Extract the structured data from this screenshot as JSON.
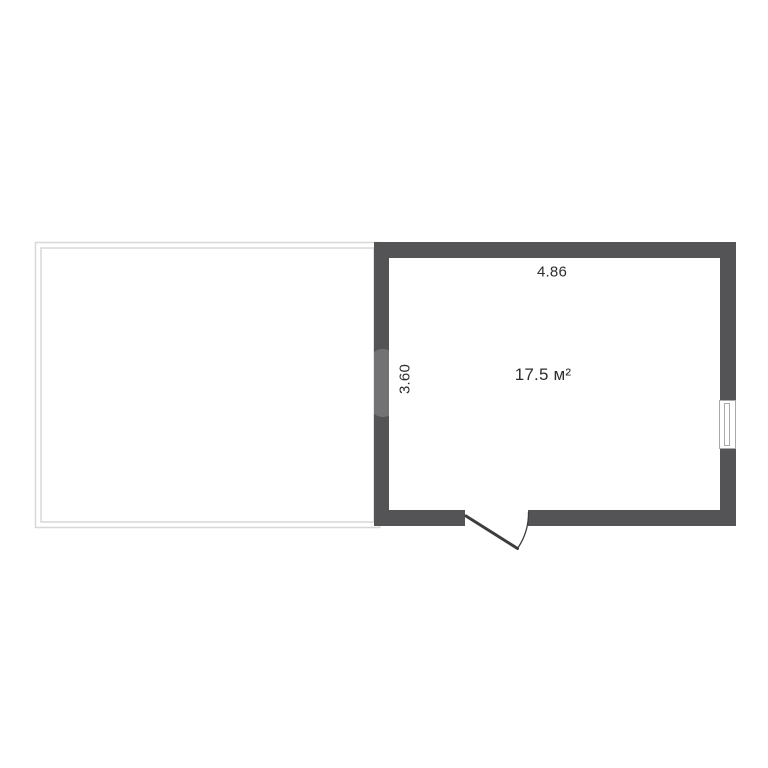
{
  "floor_plan": {
    "labels": {
      "room_width_m": "4.86",
      "room_height_m": "3.60",
      "room_area": "17.5 м²"
    },
    "colors": {
      "wall": "#545456",
      "terrace": "#d7d7d7",
      "door": "#3d3d40",
      "text": "#2d2d2d",
      "background": "#ffffff"
    }
  }
}
